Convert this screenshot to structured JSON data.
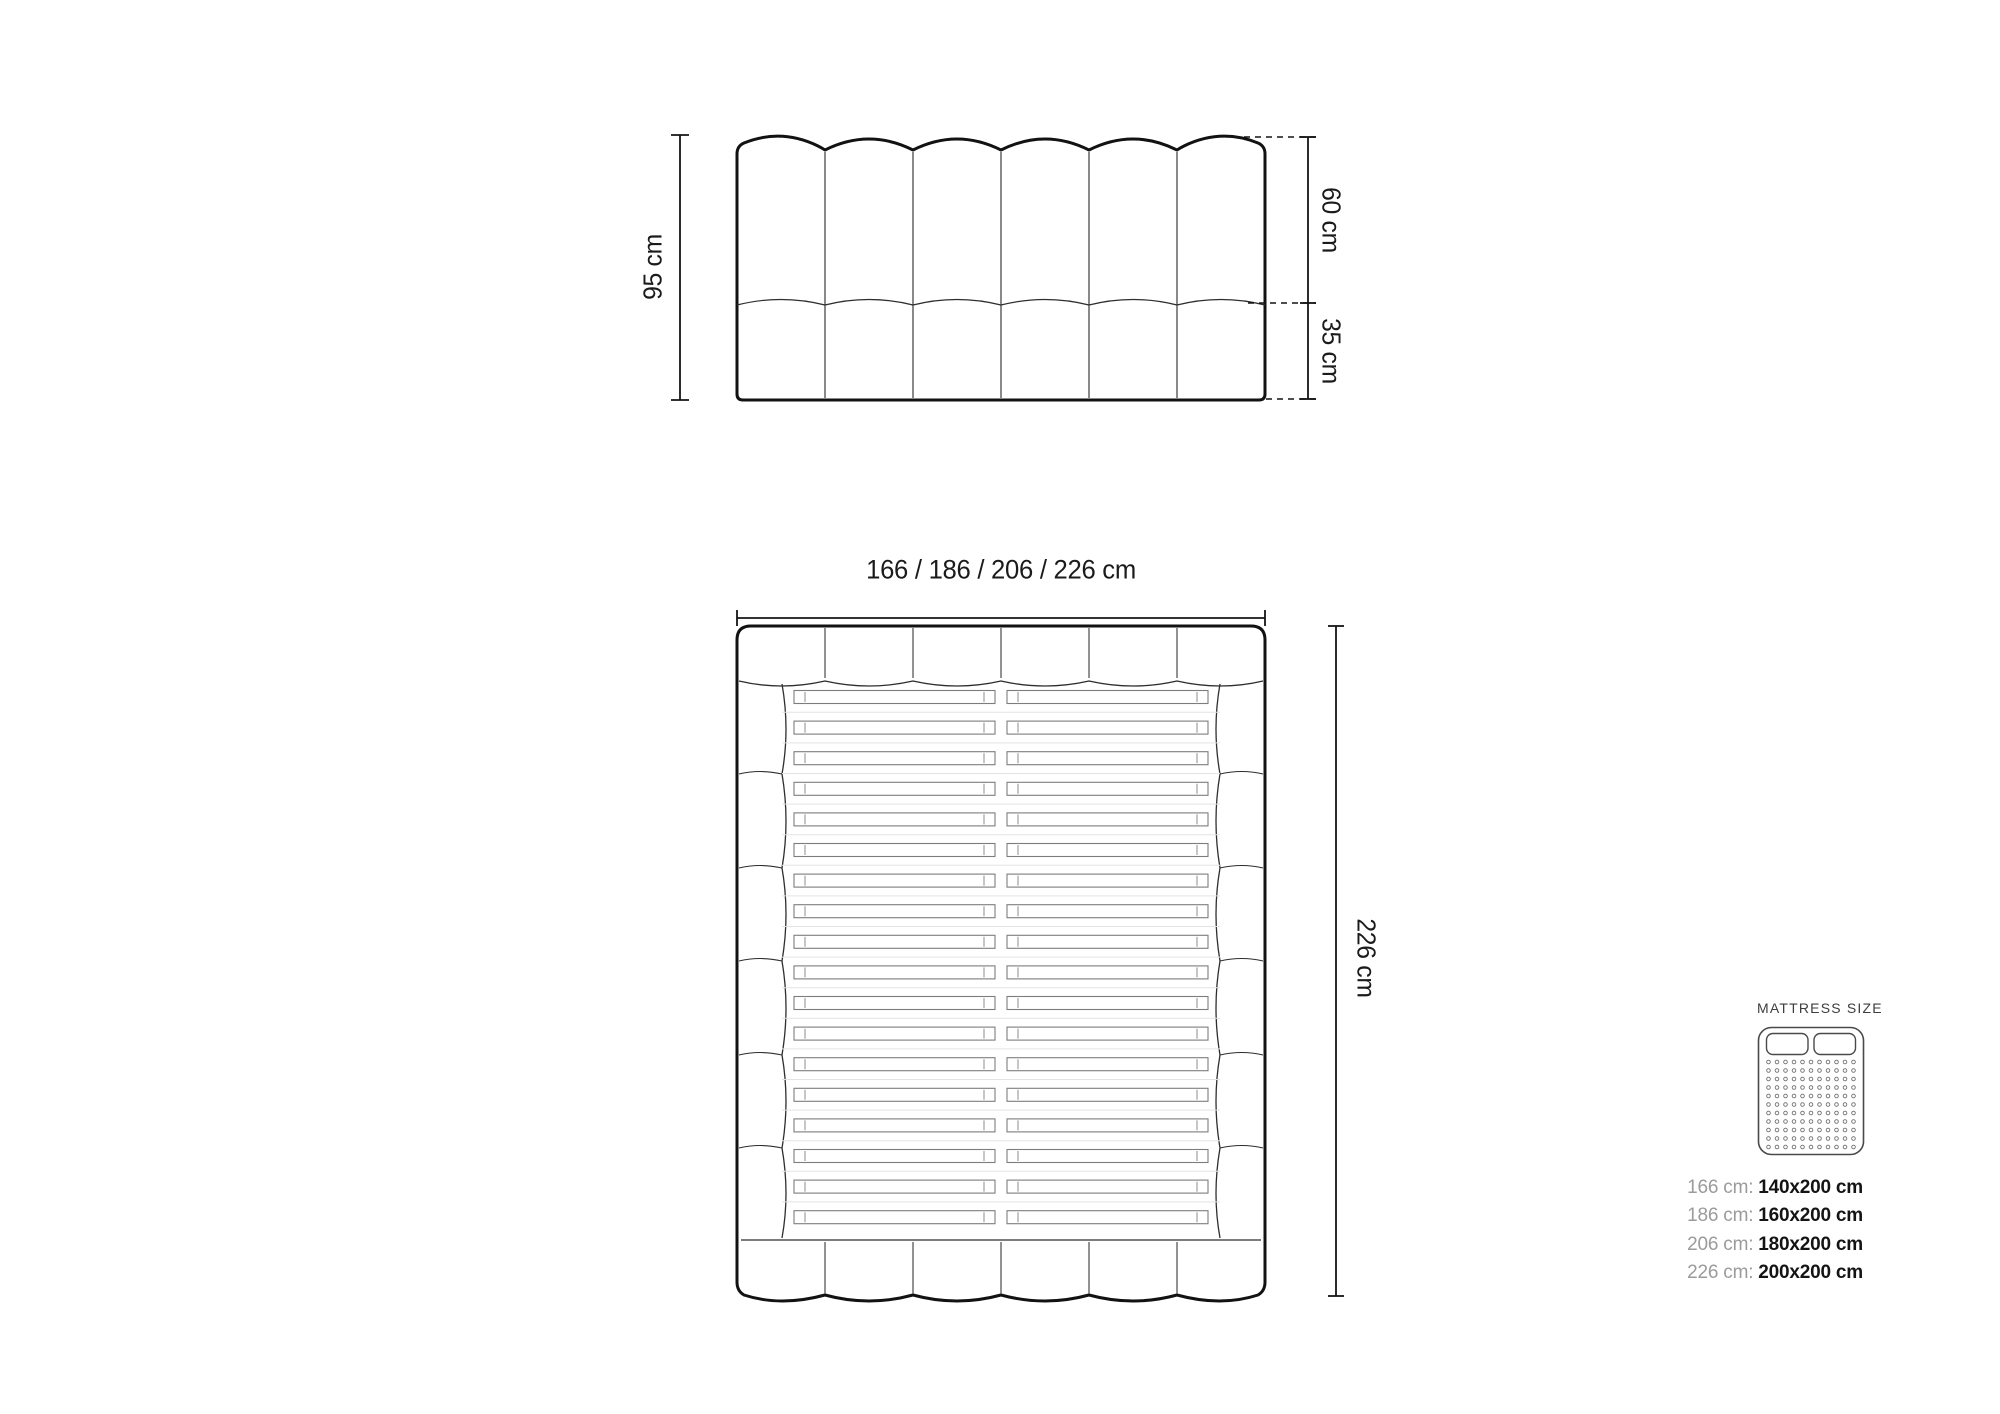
{
  "diagram": {
    "headboard_front": {
      "height_label": "95 cm",
      "upper_section_label": "60 cm",
      "lower_section_label": "35 cm"
    },
    "bed_top": {
      "width_label": "166 / 186 / 206 / 226 cm",
      "length_label": "226 cm"
    }
  },
  "mattress_legend": {
    "title": "MATTRESS SIZE",
    "mattress_icon": "double-mattress-with-two-pillows-icon",
    "sizes": [
      {
        "frame": "166 cm:",
        "mattress": "140x200 cm"
      },
      {
        "frame": "186 cm:",
        "mattress": "160x200 cm"
      },
      {
        "frame": "206 cm:",
        "mattress": "180x200 cm"
      },
      {
        "frame": "226 cm:",
        "mattress": "200x200 cm"
      }
    ]
  },
  "colors": {
    "outline": "#121212",
    "thin_line": "#3c3c3c",
    "slat_line": "#7d7d7d",
    "faint_line": "#e3e3e3",
    "label_text": "#1b1b1b",
    "legend_prefix": "#9b9b9b",
    "legend_value": "#141414"
  }
}
